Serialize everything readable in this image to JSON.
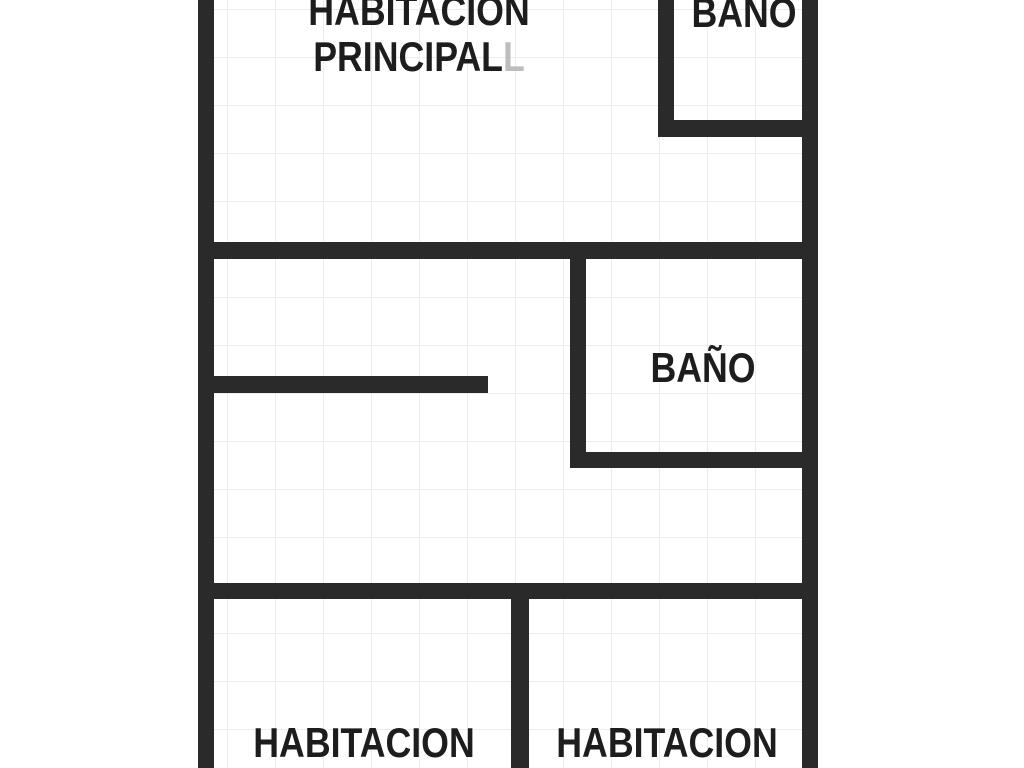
{
  "figure": {
    "type": "floor-plan",
    "colors": {
      "wall": "#2a2a2a",
      "label": "#1d1d1d",
      "ghost": "#bdbdbd",
      "grid": "#ededed",
      "bg": "#ffffff"
    },
    "labels": {
      "principal_line1": "HABITACION",
      "principal_line2": "PRINCIPAL",
      "principal_ghost": "L",
      "bano_top": "BAÑO",
      "bano_mid": "BAÑO",
      "habitacion_left": "HABITACION",
      "habitacion_right": "HABITACION"
    },
    "walls": [
      {
        "name": "outer-wall-left",
        "x": 198,
        "y": 0,
        "w": 16,
        "h": 768
      },
      {
        "name": "outer-wall-right",
        "x": 802,
        "y": 0,
        "w": 16,
        "h": 768
      },
      {
        "name": "top-bathroom-left-wall",
        "x": 658,
        "y": 0,
        "w": 16,
        "h": 137
      },
      {
        "name": "top-bathroom-bottom-wall",
        "x": 658,
        "y": 120,
        "w": 160,
        "h": 17
      },
      {
        "name": "master-bedroom-bottom-wall",
        "x": 198,
        "y": 242,
        "w": 620,
        "h": 17
      },
      {
        "name": "mid-bathroom-left-wall",
        "x": 570,
        "y": 242,
        "w": 16,
        "h": 226
      },
      {
        "name": "mid-bathroom-bottom-wall",
        "x": 570,
        "y": 452,
        "w": 248,
        "h": 16
      },
      {
        "name": "hall-partition-wall",
        "x": 198,
        "y": 376,
        "w": 290,
        "h": 17
      },
      {
        "name": "bedrooms-top-wall",
        "x": 198,
        "y": 583,
        "w": 620,
        "h": 16
      },
      {
        "name": "bedrooms-divider-wall",
        "x": 511,
        "y": 590,
        "w": 18,
        "h": 178
      }
    ]
  }
}
